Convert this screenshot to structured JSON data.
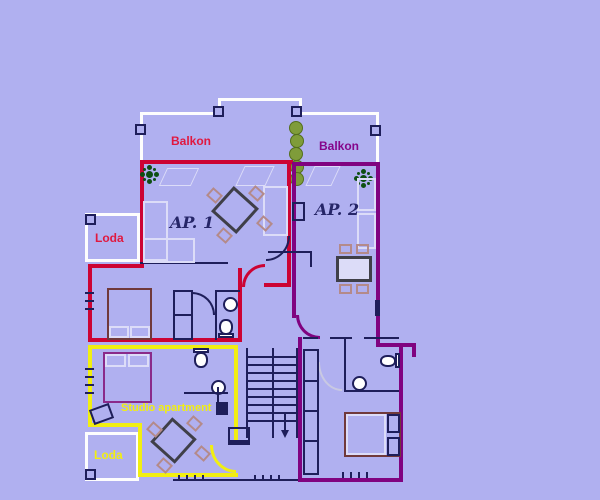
{
  "floorplan": {
    "labels": {
      "balkon_left": "Balkon",
      "balkon_right": "Balkon",
      "ap1": "AP. 1",
      "ap2": "AP. 2",
      "loda_top": "Loda",
      "loda_bottom": "Loda",
      "studio": "Studio apartment"
    },
    "colors": {
      "background": "#b0b0f0",
      "wall_red": "#cc0333",
      "wall_purple": "#800380",
      "wall_yellow": "#f1ee12",
      "wall_white": "#fdfdfd",
      "line_navy": "#1e1e5a",
      "label_red": "#e0183f",
      "label_purple": "#85058a",
      "label_yellow": "#f1ee12",
      "label_navy": "#262668",
      "furniture_light": "#dcdcf8",
      "chair_rosy": "#b48a8a",
      "table_dark": "#3f3f48",
      "bed_maroon": "#70393b",
      "bed_studio_purple": "#8a2a8a",
      "plant_green": "#0e4f12",
      "bush_olive": "#7f9c3a",
      "bush_olive_dark": "#546f1d",
      "door_arc_gray": "#c9c9e2",
      "fixture_white": "#ffffff"
    }
  }
}
